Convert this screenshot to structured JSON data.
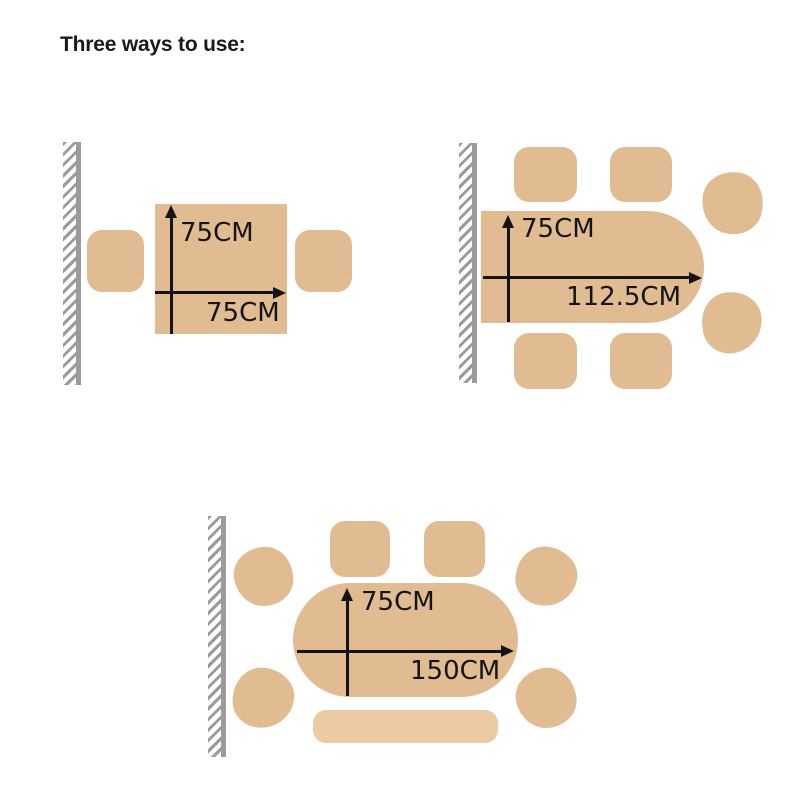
{
  "title": "Three ways to use:",
  "colors": {
    "furniture": "#e1bc93",
    "bench": "#eccaa3",
    "wall": "#9b9b9b",
    "ink": "#141414",
    "background": "#ffffff"
  },
  "diagrams": [
    {
      "id": "square-table-against-wall",
      "height_label": "75CM",
      "width_label": "75CM"
    },
    {
      "id": "half-extended-table",
      "height_label": "75CM",
      "width_label": "112.5CM"
    },
    {
      "id": "fully-extended-oval-table",
      "height_label": "75CM",
      "width_label": "150CM"
    }
  ]
}
